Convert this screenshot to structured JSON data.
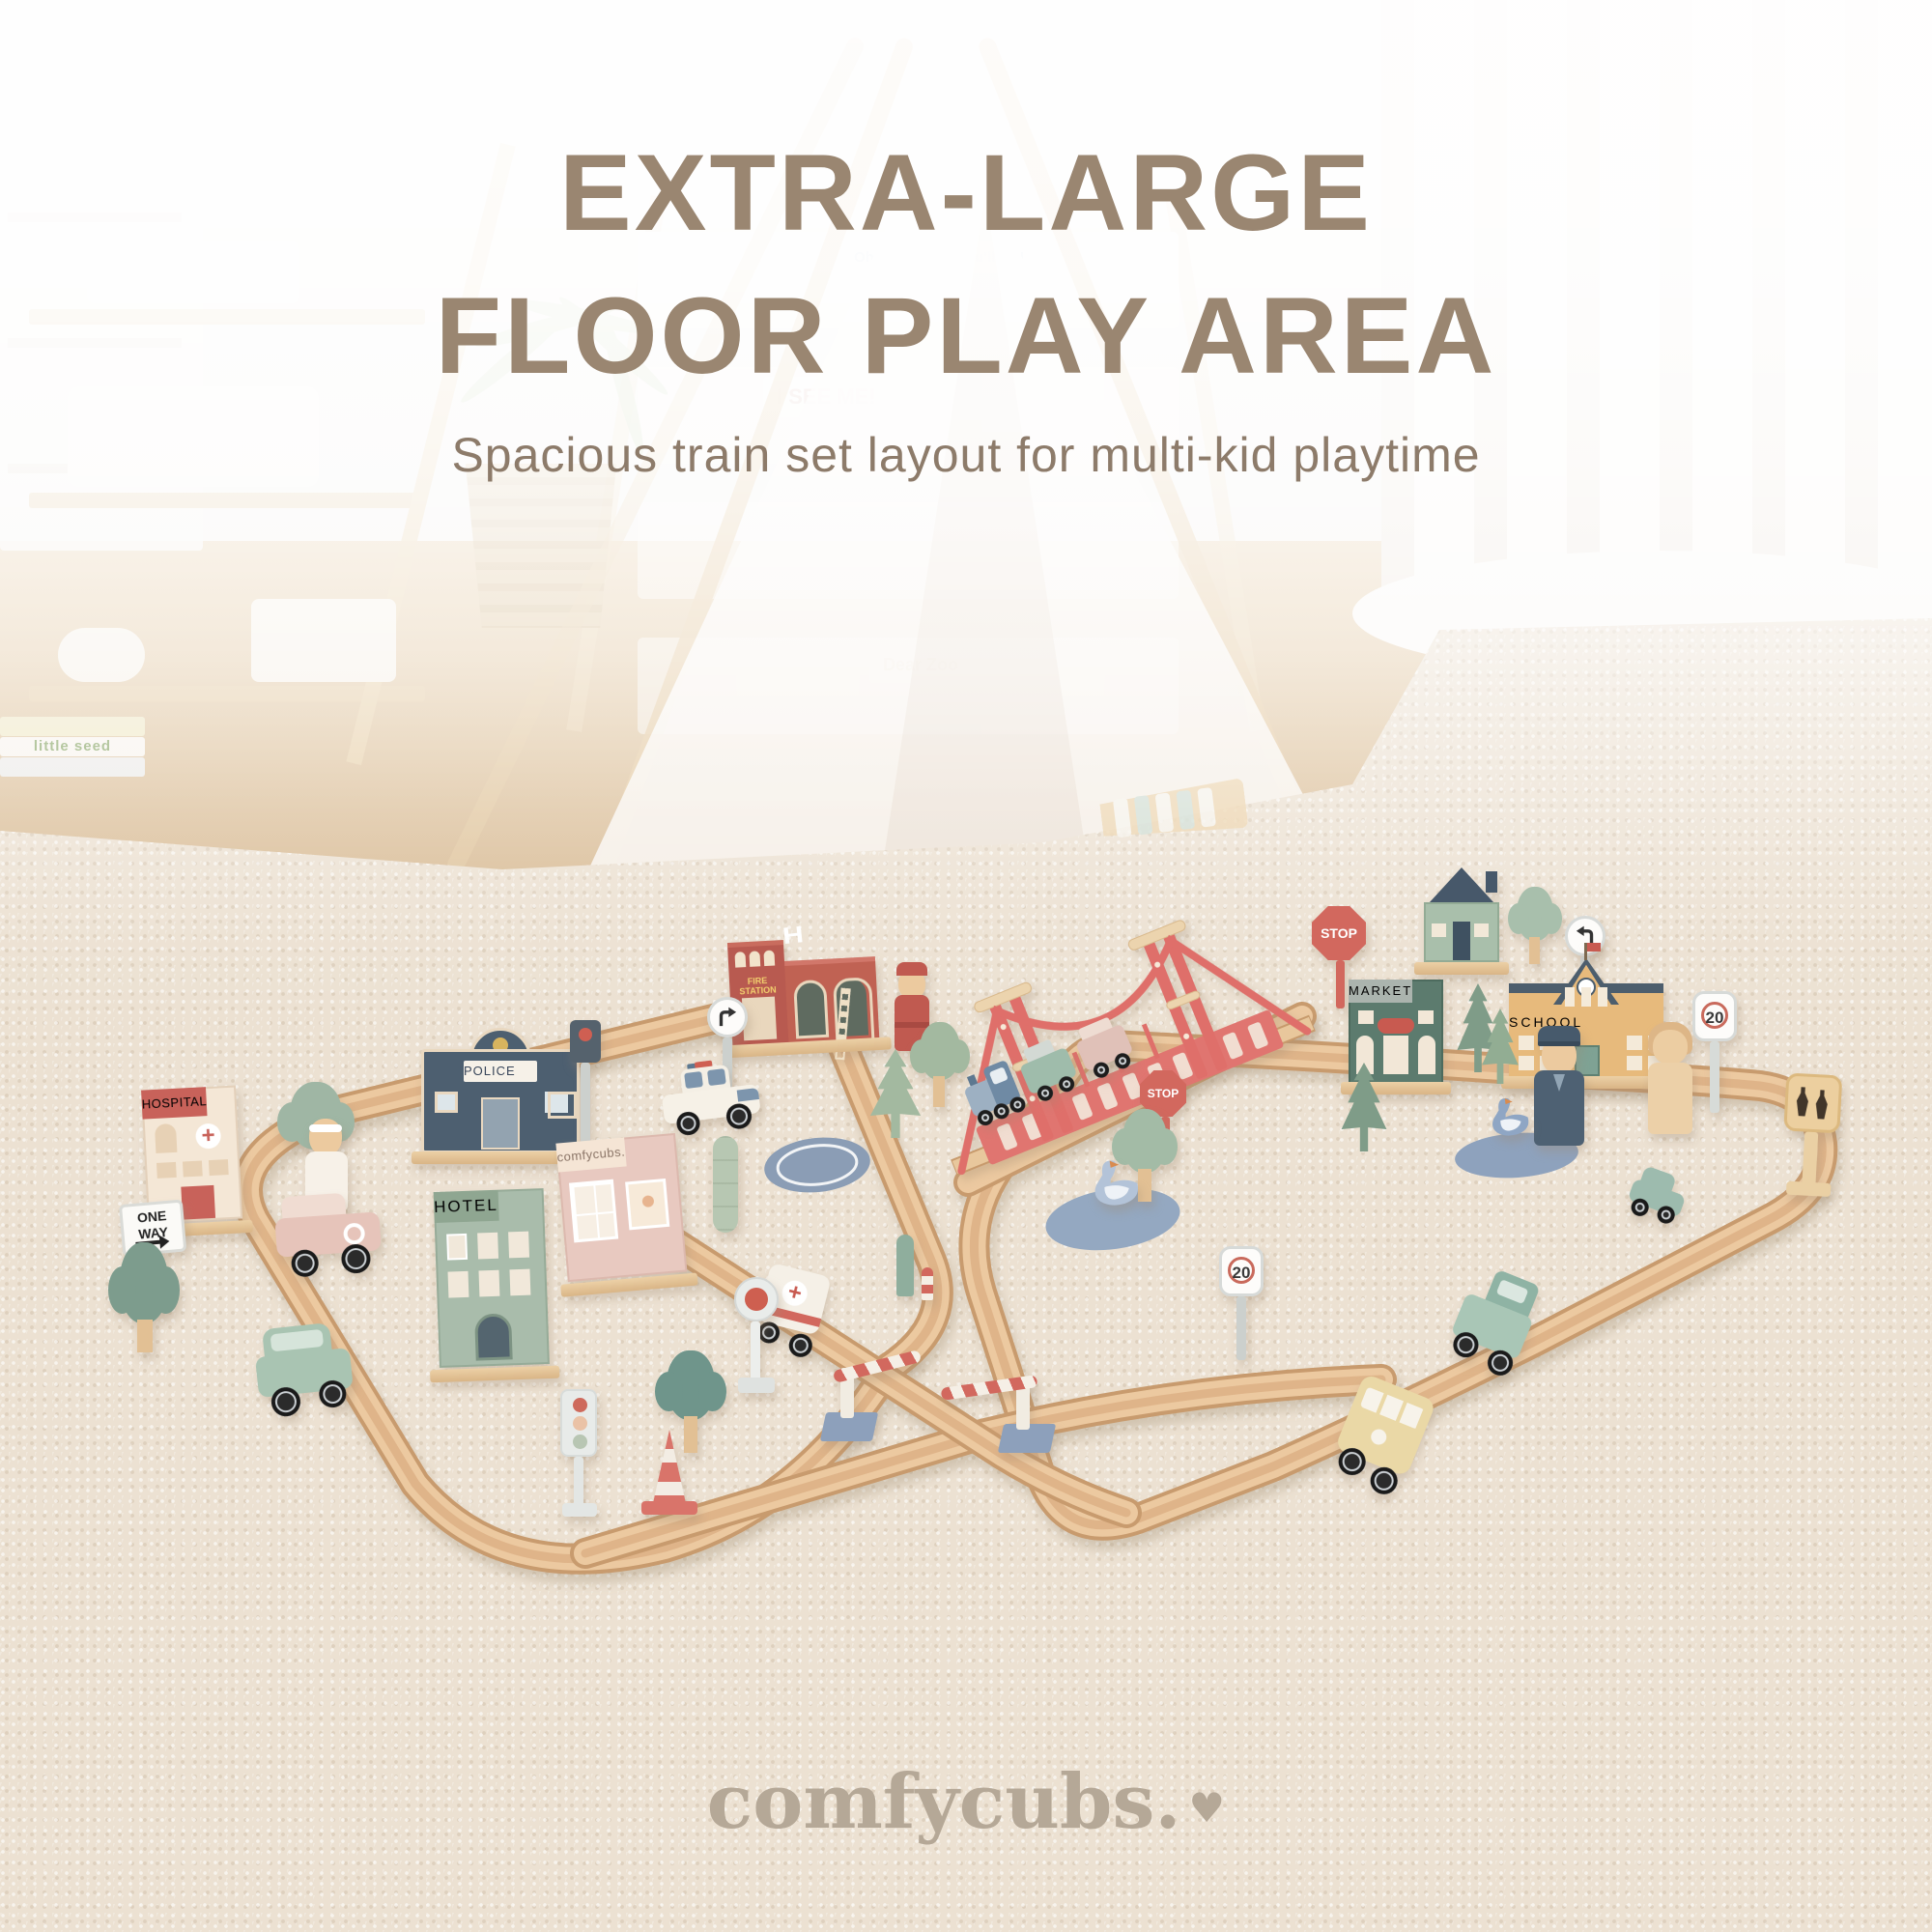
{
  "header": {
    "title_line1": "EXTRA-LARGE",
    "title_line2": "FLOOR PLAY AREA",
    "subtitle": "Spacious train set layout for multi-kid playtime"
  },
  "brand": {
    "logo": "comfycubs.",
    "heart": "♥"
  },
  "scene": {
    "buildings": {
      "hospital": "HOSPITAL",
      "police": "POLICE",
      "fire_station": "FIRE STATION",
      "hotel": "HOTEL",
      "shop": "comfycubs.",
      "market": "MARKET",
      "school": "SCHOOL"
    },
    "signs": {
      "one_way": "ONE WAY",
      "stop": "STOP",
      "speed_limit": "20",
      "helipad": "H"
    }
  },
  "background": {
    "books": [
      "Oh, the Places You'll Go!",
      "I SEE ME!",
      "Dear Zoo",
      "little seed"
    ]
  },
  "colors": {
    "headline": "#9A8671",
    "subtitle": "#8D7B6A",
    "logo": "#B5A897",
    "carpet": "#ECE1D2",
    "track_wood": "#ECC9A0",
    "bridge_red": "#DF6F6A",
    "stop_red": "#D2685E",
    "pond_blue": "#94A8C1",
    "helipad_blue": "#8B9DB5"
  }
}
